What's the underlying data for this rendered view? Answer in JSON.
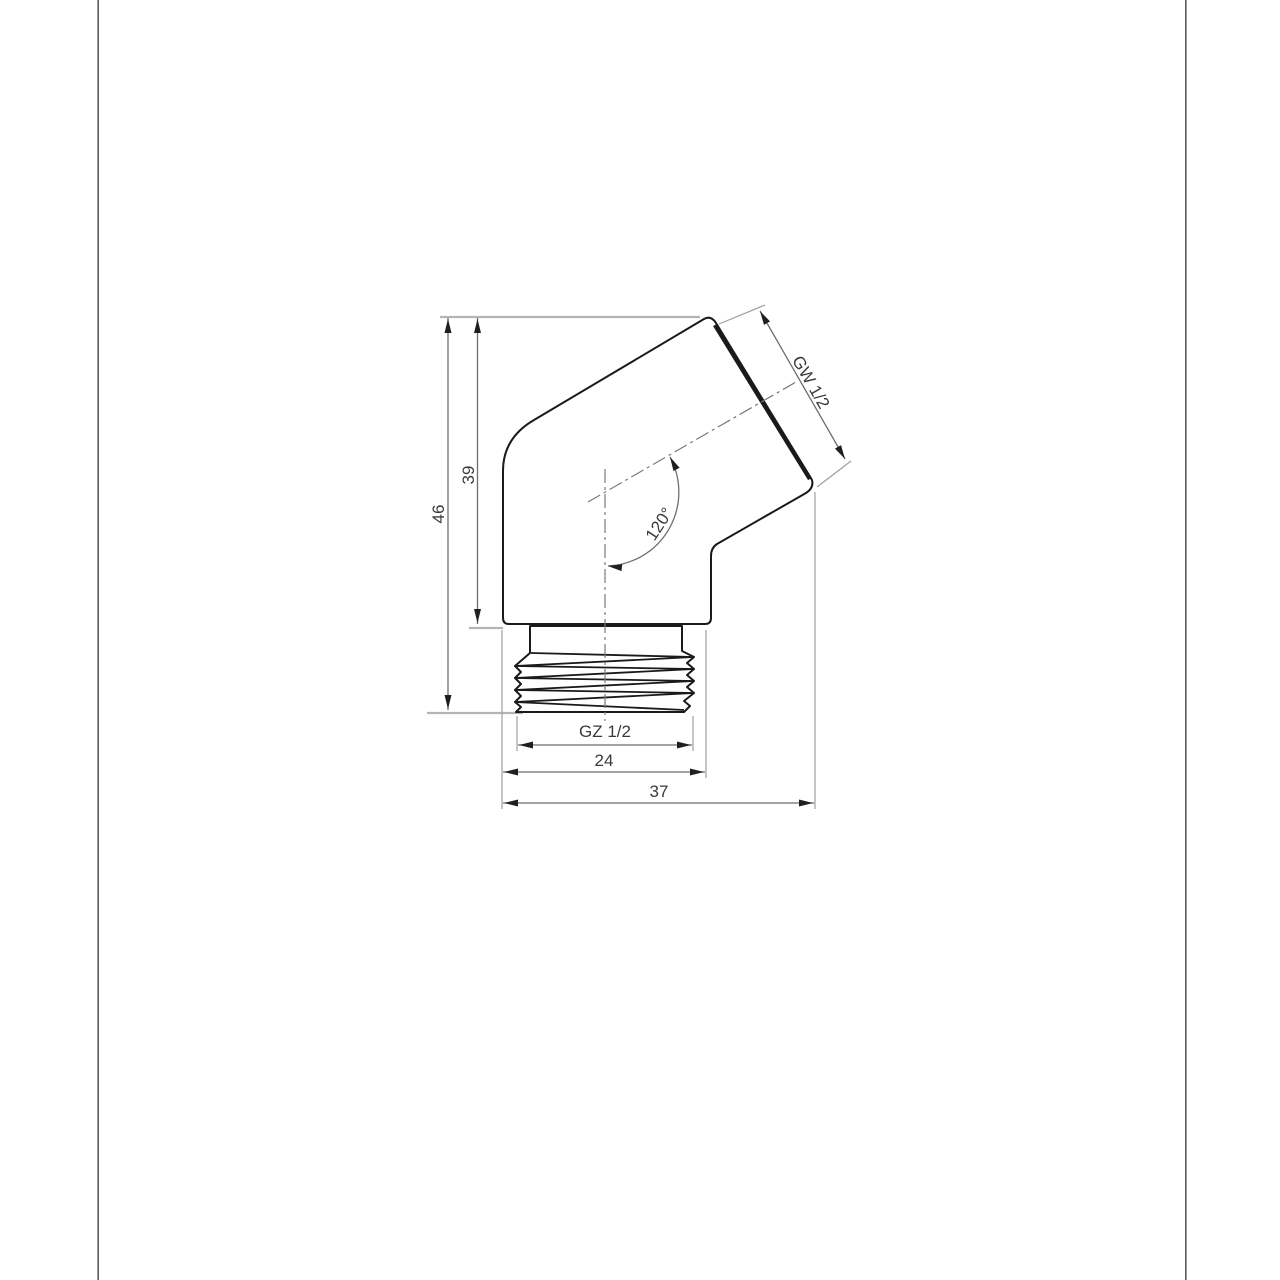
{
  "page": {
    "background": "#ffffff",
    "edge_line_dark": "#414141",
    "edge_line_light": "#b8b8b8"
  },
  "drawing": {
    "type": "technical-dimension-drawing",
    "subject": "120-degree elbow hose connector with external thread",
    "labels": {
      "dim_height_total": "46",
      "dim_height_body": "39",
      "thread_top": "GW 1/2",
      "angle": "120°",
      "thread_bottom": "GZ 1/2",
      "dim_width_thread": "24",
      "dim_width_total": "37"
    },
    "colors": {
      "outline": "#1a1a1a",
      "dimension_line": "#6e6e6e",
      "extension_line": "#9e9e9e",
      "light_extension_line": "#b4b4b4",
      "centerline": "#7a7a7a",
      "text": "#3a3a3a"
    }
  }
}
